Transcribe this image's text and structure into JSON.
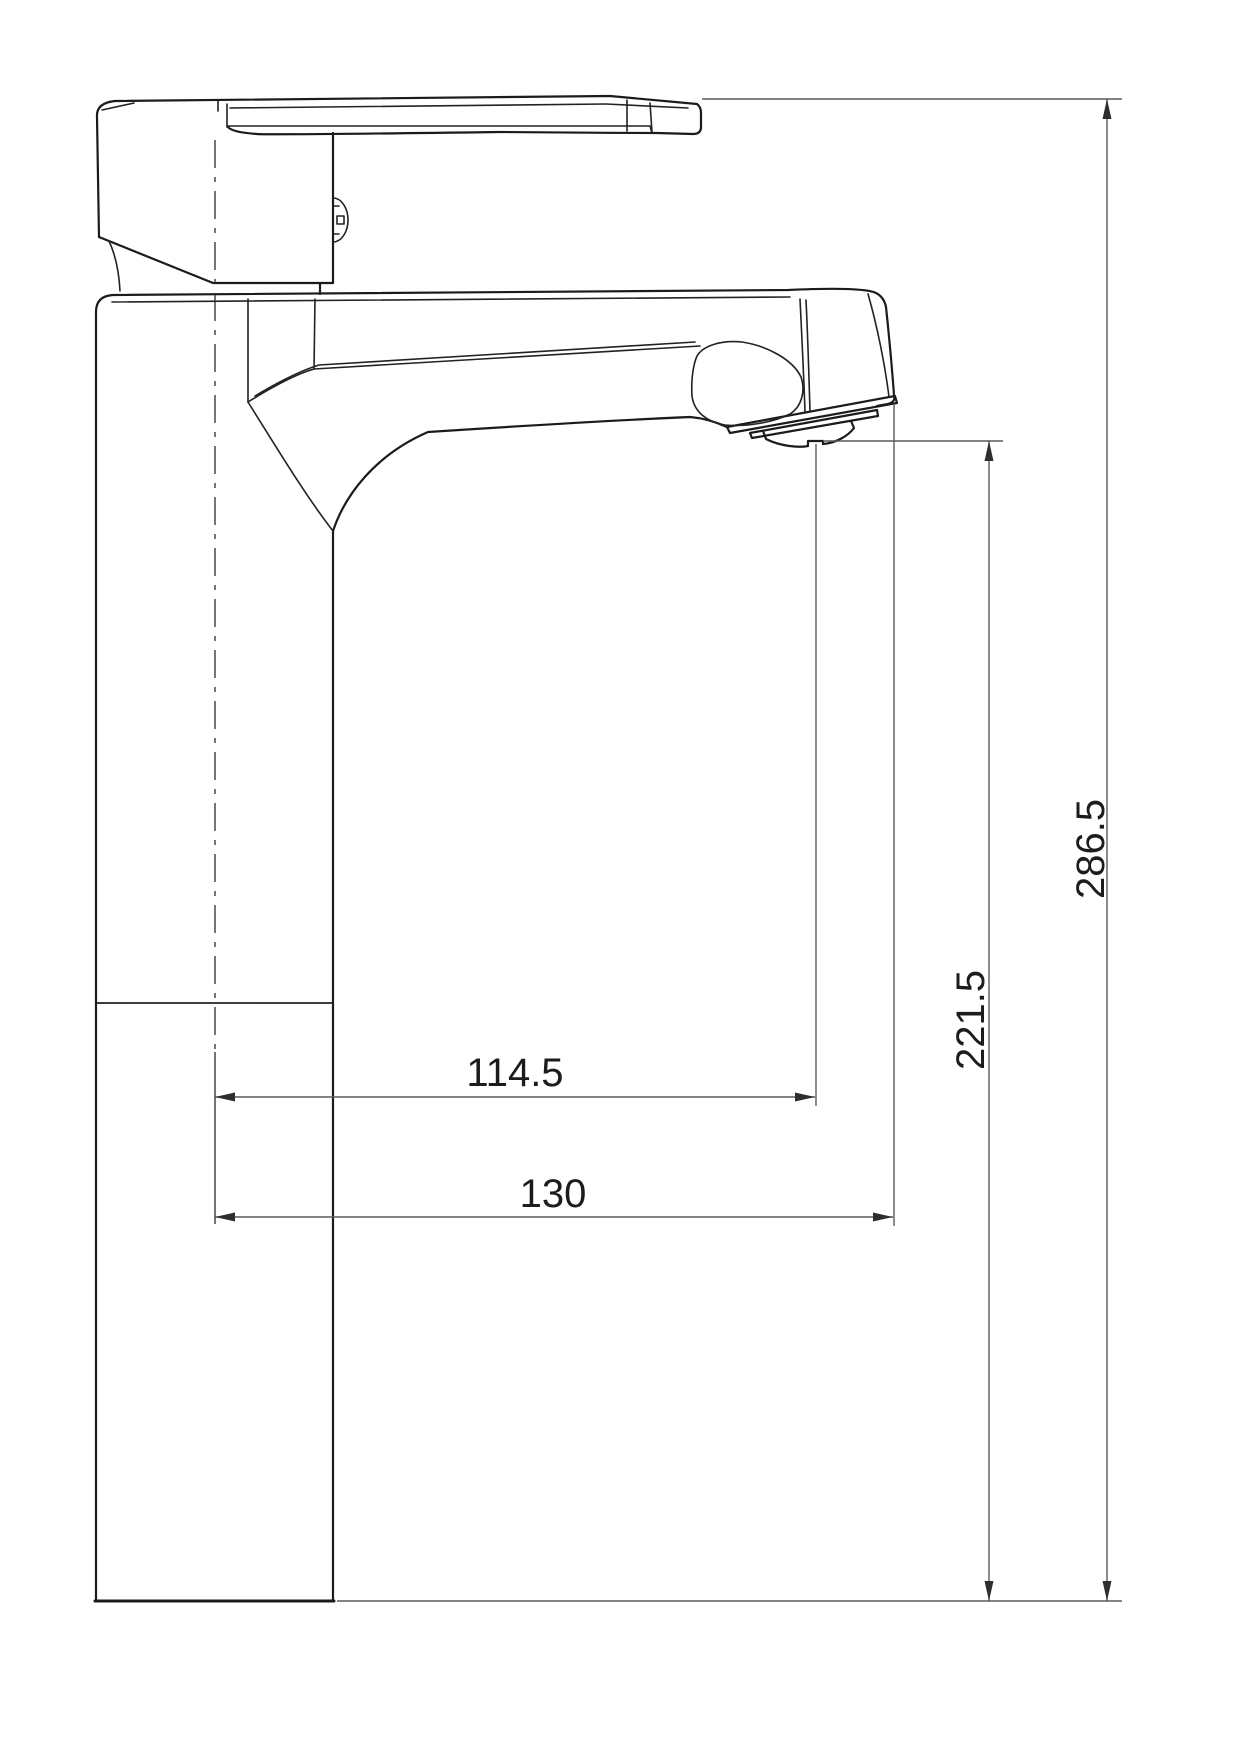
{
  "drawing": {
    "kind": "faucet-technical-drawing",
    "dimensions": {
      "overall_height": "286.5",
      "outlet_height": "221.5",
      "spout_reach": "114.5",
      "overall_reach": "130"
    },
    "colors": {
      "outline": "#1b1b1b",
      "internal_line": "#222222",
      "dimension_line": "#5a5a5a",
      "arrow": "#2e2e2e",
      "text": "#1c1c1c",
      "background": "#ffffff"
    }
  }
}
